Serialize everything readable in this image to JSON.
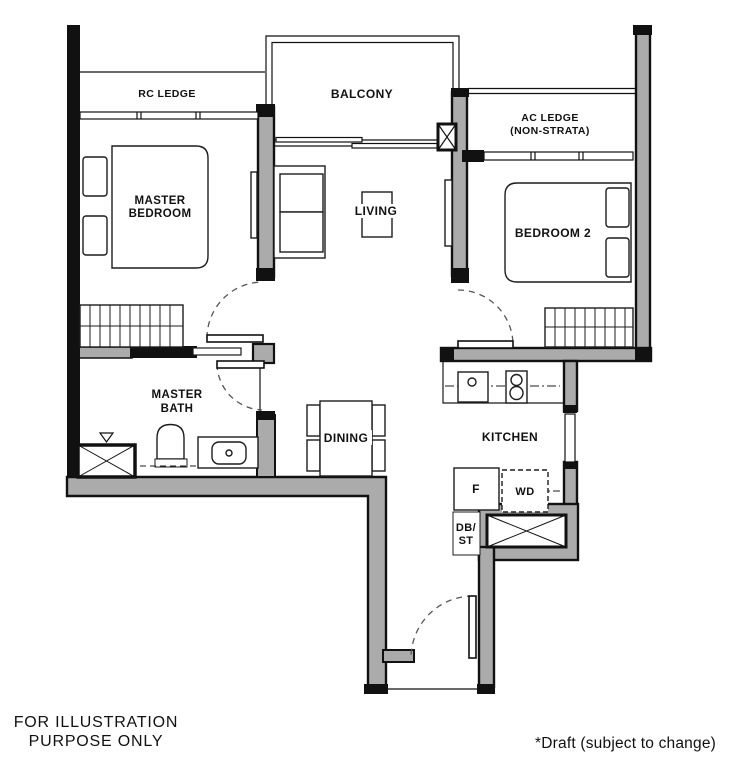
{
  "plan": {
    "type": "floor-plan",
    "labels": {
      "rc_ledge": "RC LEDGE",
      "balcony": "BALCONY",
      "ac_ledge_1": "AC LEDGE",
      "ac_ledge_2": "(NON-STRATA)",
      "master_bedroom_1": "MASTER",
      "master_bedroom_2": "BEDROOM",
      "bedroom2": "BEDROOM 2",
      "living": "LIVING",
      "master_bath_1": "MASTER",
      "master_bath_2": "BATH",
      "dining": "DINING",
      "kitchen": "KITCHEN",
      "fridge": "F",
      "washer_dryer": "WD",
      "db_st_1": "DB/",
      "db_st_2": "ST"
    },
    "symbols": {
      "shower_box": "crossed-box",
      "ac_condenser_box": "crossed-box",
      "column_marker": "crossed-box",
      "floor_trap": "triangle"
    },
    "colors": {
      "wall_fill": "#ababab",
      "line": "#111111",
      "background": "#ffffff"
    }
  },
  "footnotes": {
    "left_1": "FOR ILLUSTRATION",
    "left_2": "PURPOSE ONLY",
    "right": "*Draft (subject to change)"
  }
}
